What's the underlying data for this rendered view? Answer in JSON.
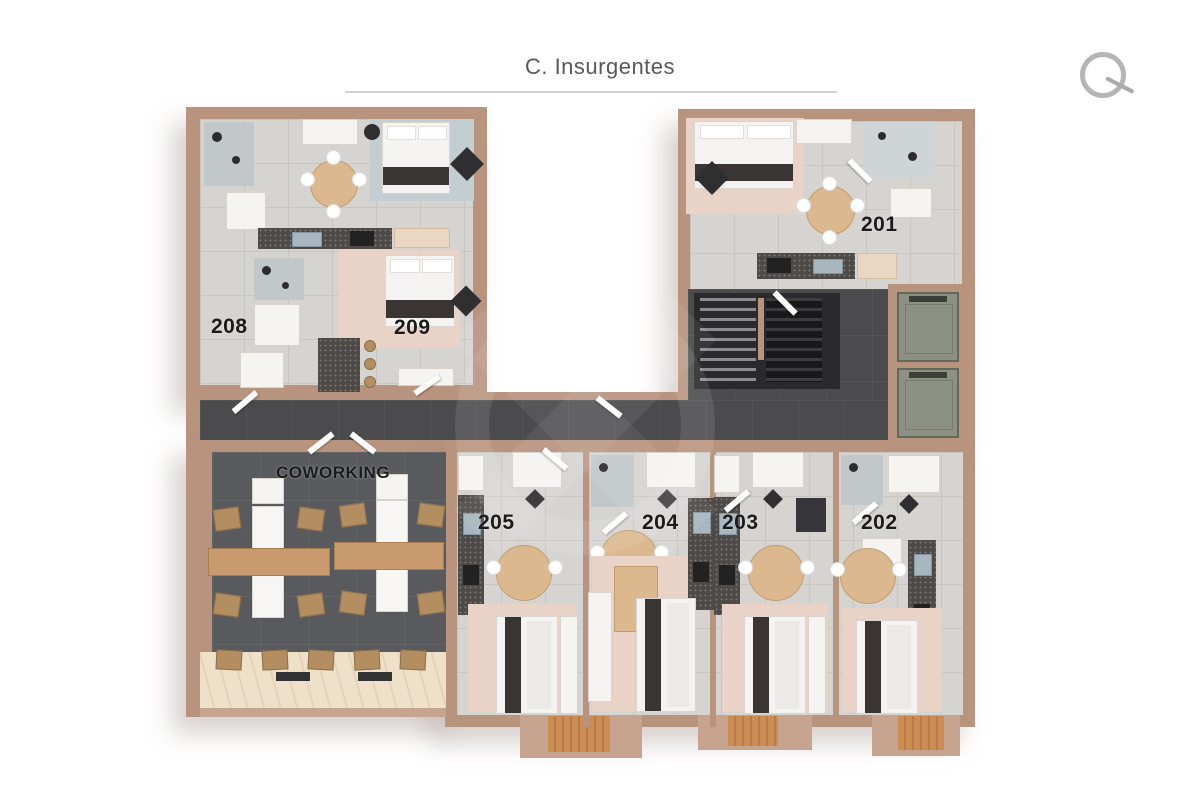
{
  "header": {
    "street_label": "C. Insurgentes"
  },
  "compass": {
    "icon": "north-indicator"
  },
  "plan": {
    "coworking_label": "COWORKING",
    "units": [
      {
        "id": "201",
        "label": "201"
      },
      {
        "id": "202",
        "label": "202"
      },
      {
        "id": "203",
        "label": "203"
      },
      {
        "id": "204",
        "label": "204"
      },
      {
        "id": "205",
        "label": "205"
      },
      {
        "id": "208",
        "label": "208"
      },
      {
        "id": "209",
        "label": "209"
      }
    ],
    "colors": {
      "wall": "#b8947f",
      "unit_floor": "#d6d4d1",
      "corridor_floor": "#4b4b4e",
      "coworking_floor": "#595a5e",
      "elevator": "#8d9184",
      "bedroom_rug": "#e9d2c6",
      "wood_furniture": "#dcb88e",
      "balcony_wood": "#cc8d55",
      "label_text": "#1b1b1b",
      "title_text": "#58585a"
    }
  }
}
